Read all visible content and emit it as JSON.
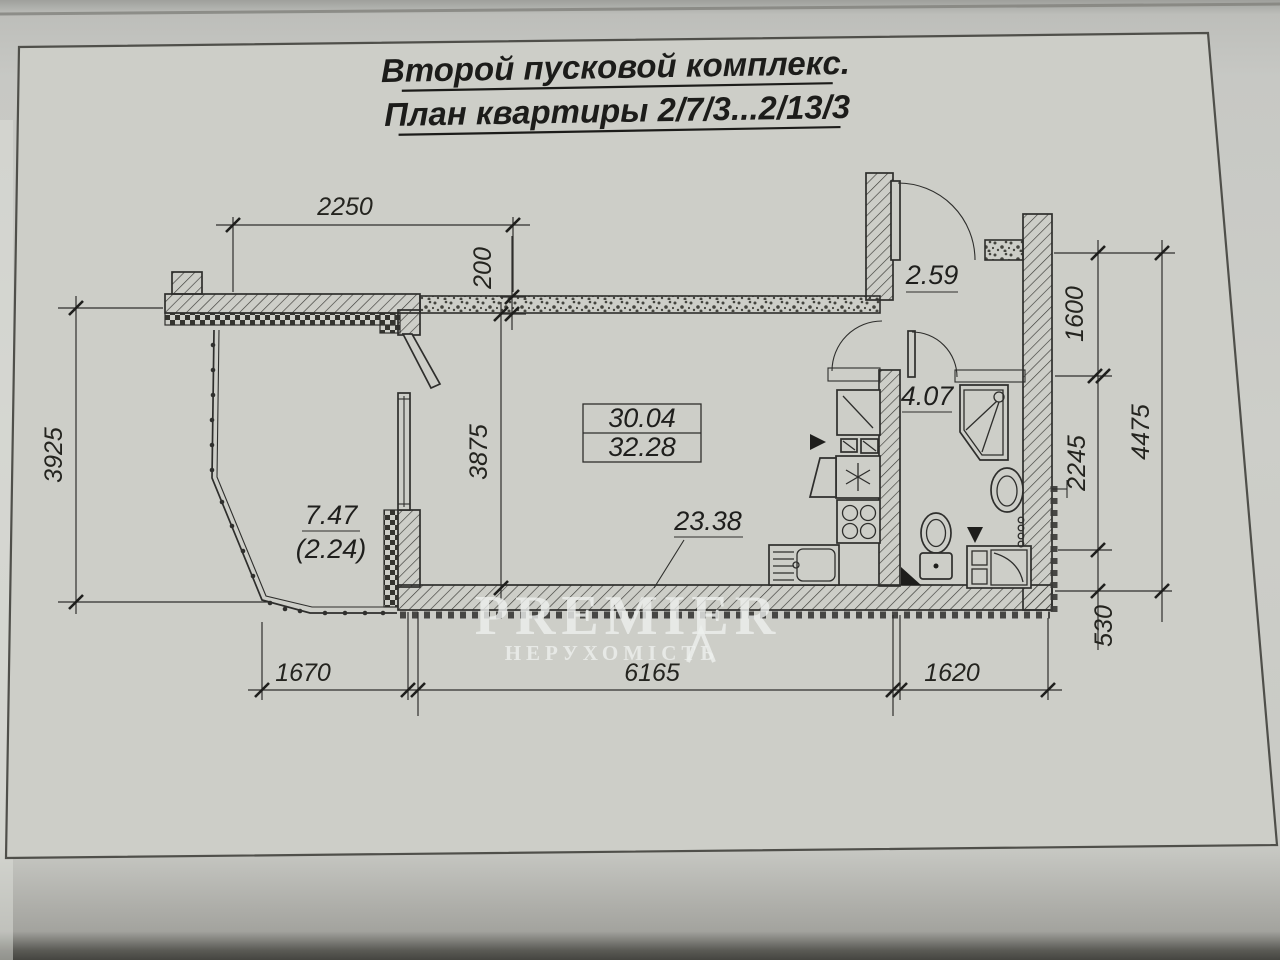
{
  "title": {
    "line1": "Второй пусковой комплекс.",
    "line2": "План квартиры 2/7/3...2/13/3"
  },
  "rooms": {
    "area_box_top": "30.04",
    "area_box_bottom": "32.28",
    "living_kitchen": "23.38",
    "balcony": "7.47",
    "balcony_coeff": "(2.24)",
    "hall": "2.59",
    "bathroom": "4.07"
  },
  "dimensions": {
    "top_width": "2250",
    "wall_thickness": "200",
    "left_height": "3925",
    "room_depth": "3875",
    "right_upper": "1600",
    "right_middle": "2245",
    "right_lower": "530",
    "right_total": "4475",
    "bottom_left": "1670",
    "bottom_middle": "6165",
    "bottom_right": "1620"
  },
  "watermark": {
    "brand": "PREMIER",
    "subtitle": "НЕРУХОМІСТЬ"
  },
  "colors": {
    "paper": "#cdcec8",
    "ink": "#2e2e2c"
  }
}
